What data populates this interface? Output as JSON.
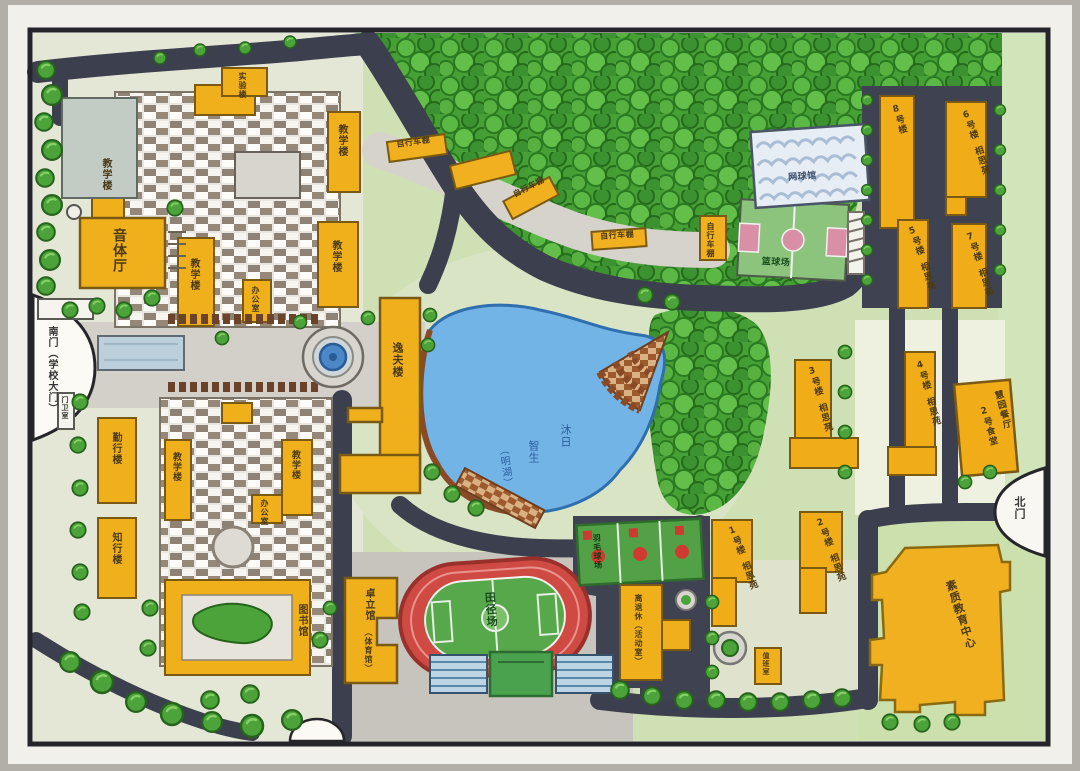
{
  "scene": {
    "kind": "hand-drawn campus master plan",
    "medium": "marker and colored pencil on paper",
    "palette": {
      "paper": "#f2f0ea",
      "frame": "#24242a",
      "grass": "#cfe0b4",
      "forest": "#46a035",
      "road": "#3c3f4d",
      "building": "#f0b01c",
      "lake": "#72b4e6",
      "track": "#cf4a42",
      "field": "#57a74b"
    }
  },
  "labels": {
    "music_hall": "音体厅",
    "teaching": "教学楼",
    "lab": "实验楼",
    "office": "办公室",
    "qinxing": "勤行楼",
    "zhixing": "知行楼",
    "yifu": "逸夫楼",
    "library": "图书馆",
    "gym": "卓立馆",
    "gym_note": "（体育馆）",
    "track": "田径场",
    "basketball": "篮球场",
    "tennis": "网球馆",
    "badminton": "羽毛球场",
    "bike_shed": "自行车棚",
    "activity": "离退休（活动室）",
    "duty": "值班室",
    "canteen1": "慧园餐厅",
    "canteen2": "2号食堂",
    "quality": "素质教育中心",
    "south_gate": "南门（学校大门）",
    "north_gate": "北门",
    "guard": "门卫室"
  },
  "lake": {
    "name": "明湖",
    "inscription": [
      "沐日",
      "智生",
      "（明湖）"
    ]
  },
  "dorms": [
    {
      "no": "1号楼",
      "name": "相思苑"
    },
    {
      "no": "2号楼",
      "name": "相思苑"
    },
    {
      "no": "3号楼",
      "name": "相思苑"
    },
    {
      "no": "4号楼",
      "name": "相思苑"
    },
    {
      "no": "5号楼",
      "name": "相思苑"
    },
    {
      "no": "6号楼",
      "name": "相思苑"
    },
    {
      "no": "7号楼",
      "name": "相思苑"
    },
    {
      "no": "8号楼",
      "name": ""
    }
  ]
}
